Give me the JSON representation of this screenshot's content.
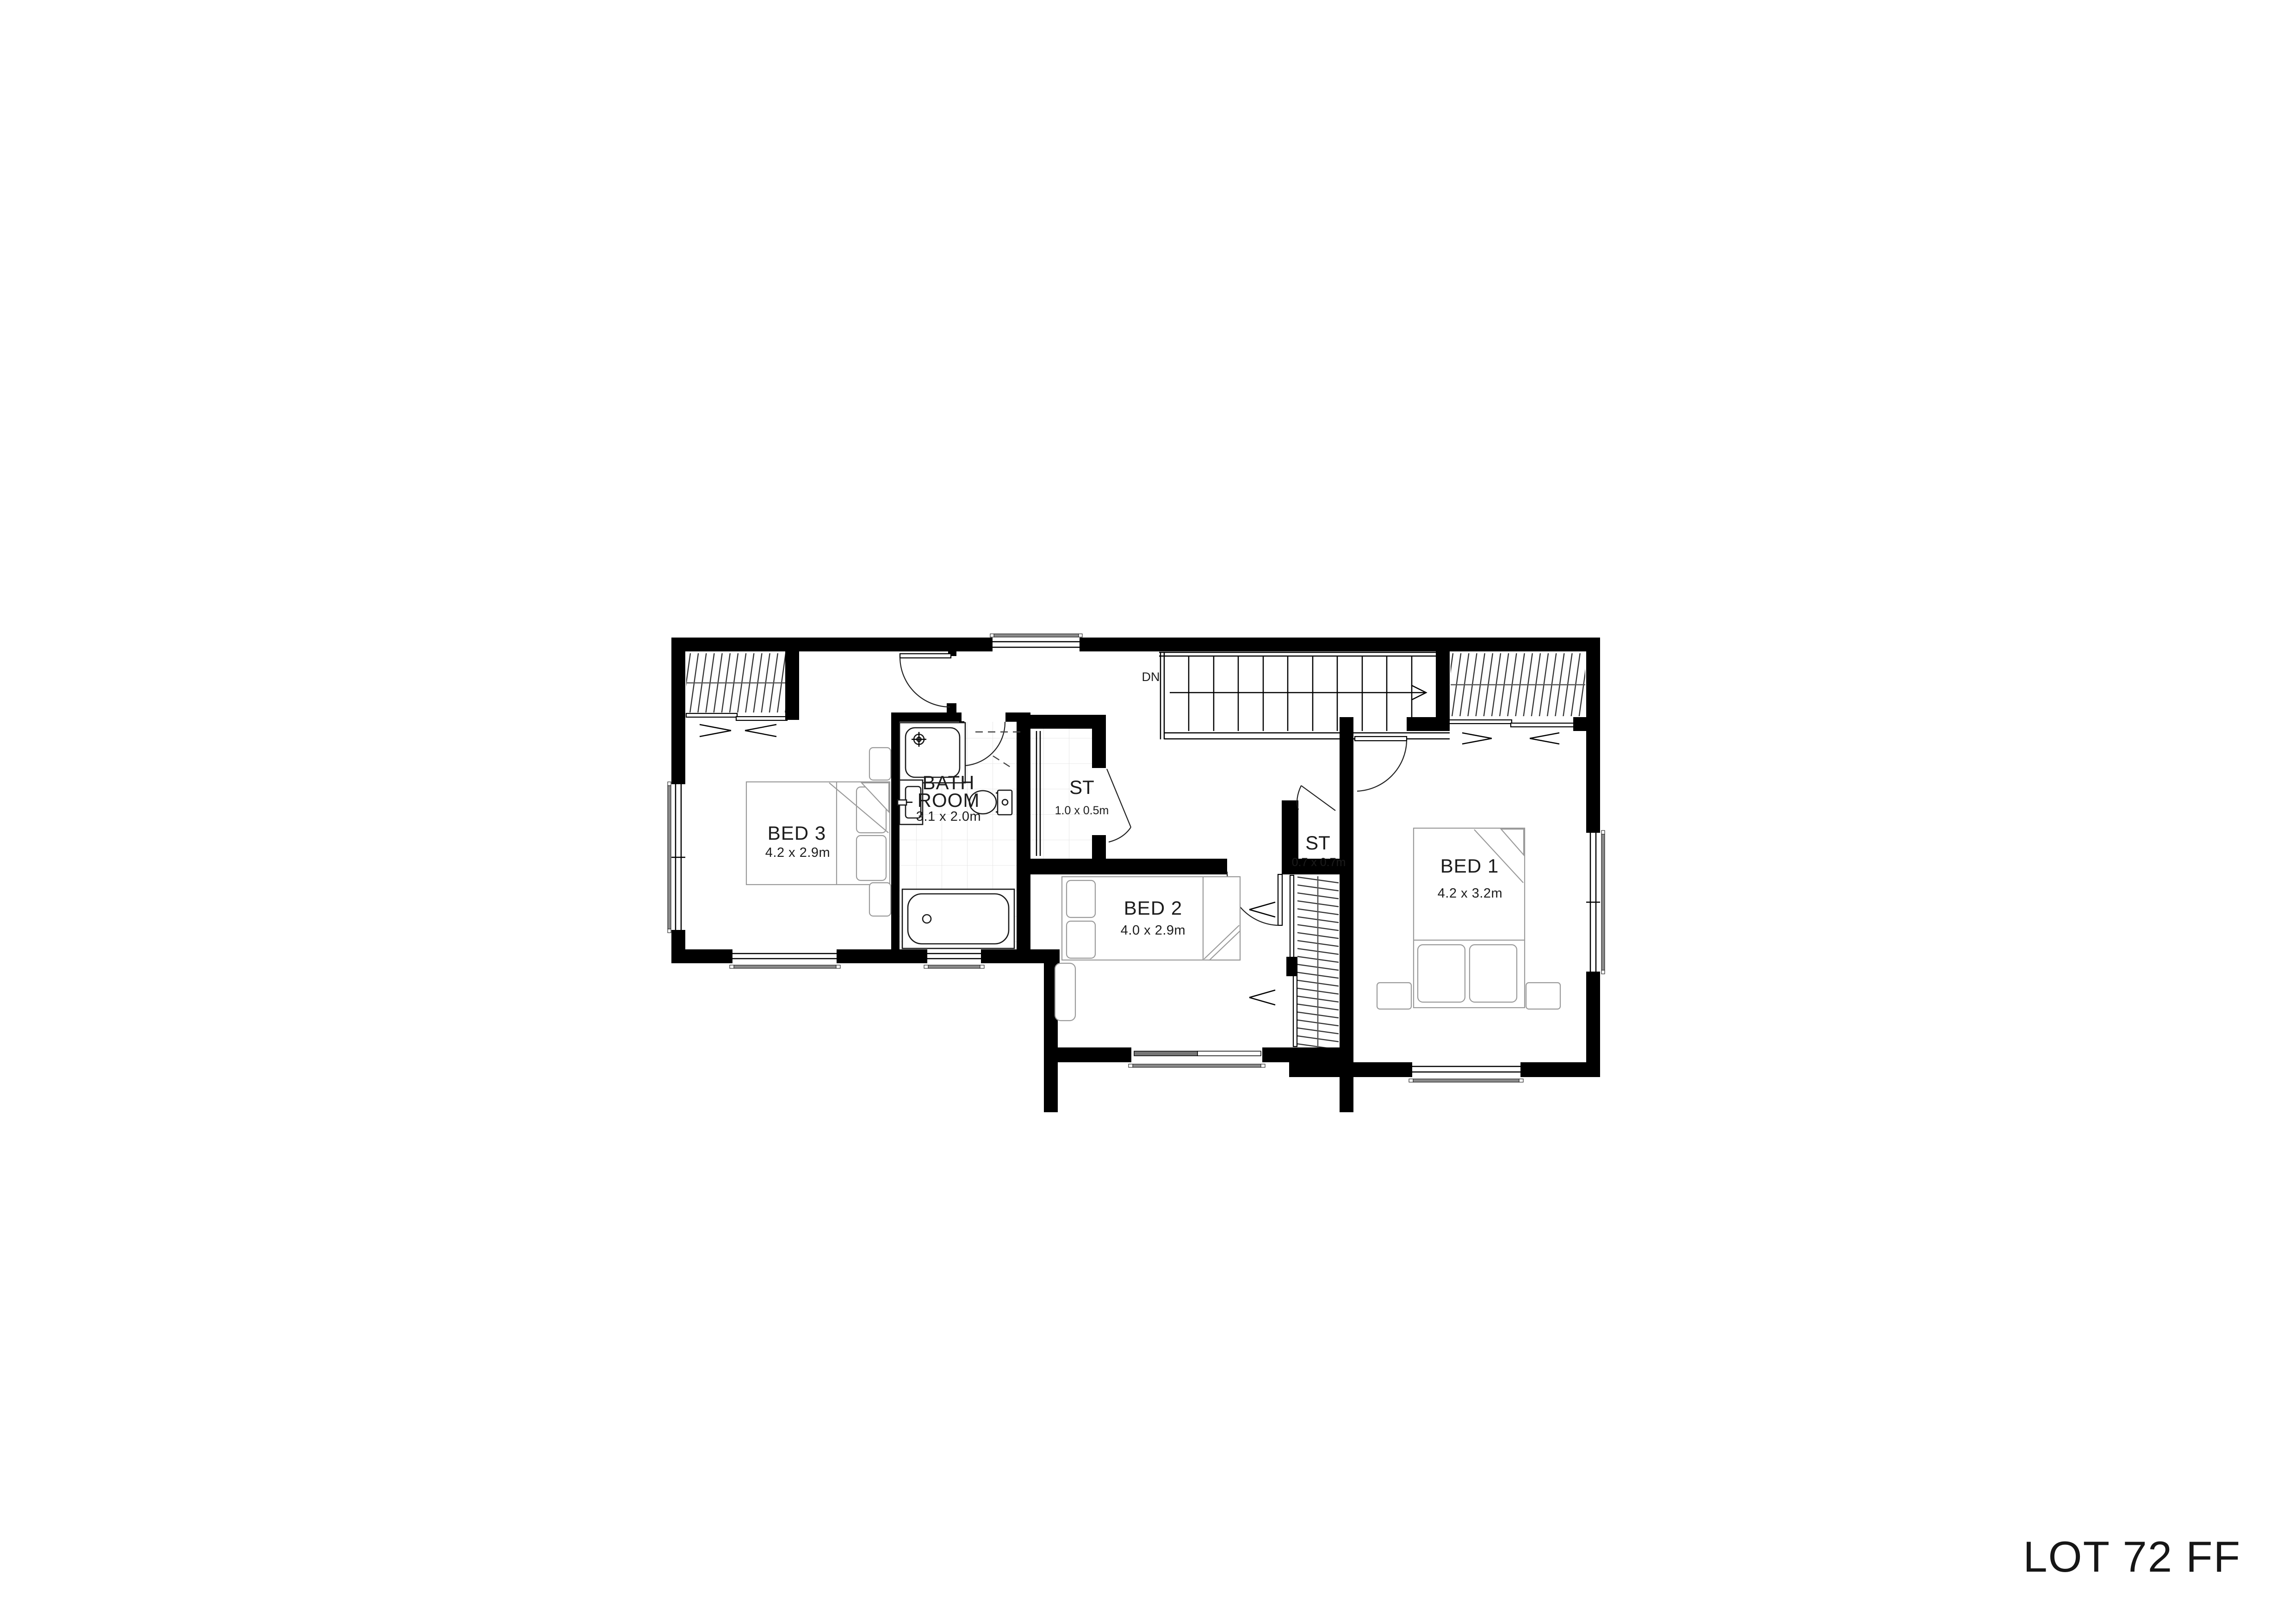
{
  "page": {
    "sheet_title": "LOT 72 FF",
    "background": "#ffffff",
    "wall_color": "#000000"
  },
  "rooms": [
    {
      "id": "bed3",
      "name": "BED 3",
      "dims": "4.2 x 2.9m"
    },
    {
      "id": "bathroom",
      "name": "BATH ROOM",
      "name_line1": "BATH",
      "name_line2": "ROOM",
      "dims": "3.1 x 2.0m"
    },
    {
      "id": "store1",
      "name": "ST",
      "dims": "1.0 x 0.5m"
    },
    {
      "id": "bed2",
      "name": "BED 2",
      "dims": "4.0 x 2.9m"
    },
    {
      "id": "store2",
      "name": "ST",
      "dims": "0.7 x 0.7m"
    },
    {
      "id": "bed1",
      "name": "BED 1",
      "dims": "4.2 x 3.2m"
    }
  ],
  "stairs": {
    "direction_label": "DN"
  }
}
